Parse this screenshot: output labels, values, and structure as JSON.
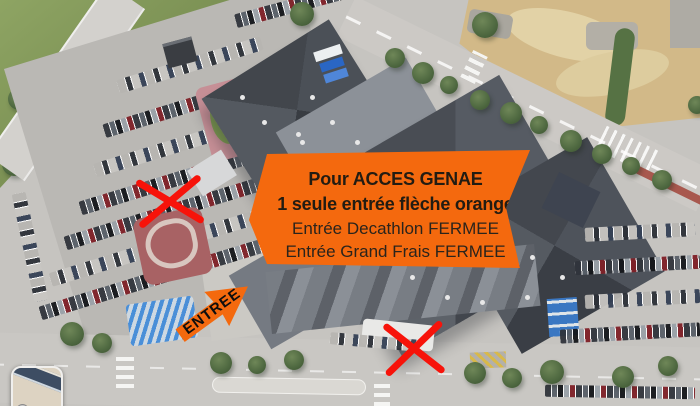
{
  "annotations": {
    "banner": {
      "lines": [
        {
          "text": "Pour ACCES GENAE",
          "bold": true
        },
        {
          "text": "1 seule entrée flèche orange",
          "bold": true
        },
        {
          "text": "Entrée Decathlon FERMEE",
          "bold": false
        },
        {
          "text": "Entrée Grand Frais FERMEE",
          "bold": false
        }
      ]
    },
    "entrance_arrow": {
      "label": "ENTREE",
      "direction": "up-right"
    },
    "closed_marks": [
      {
        "icon": "red-x-icon",
        "location": "left-decathlon-entrance"
      },
      {
        "icon": "red-x-icon",
        "location": "bottom-grand-frais-entrance"
      }
    ],
    "colors": {
      "accent_orange": "#F4690E",
      "cross_red": "#F7130A",
      "banner_text": "#221C12"
    }
  },
  "map": {
    "view": "satellite",
    "inset_thumbnail": {
      "icon": "map-inset-road-icon"
    }
  }
}
